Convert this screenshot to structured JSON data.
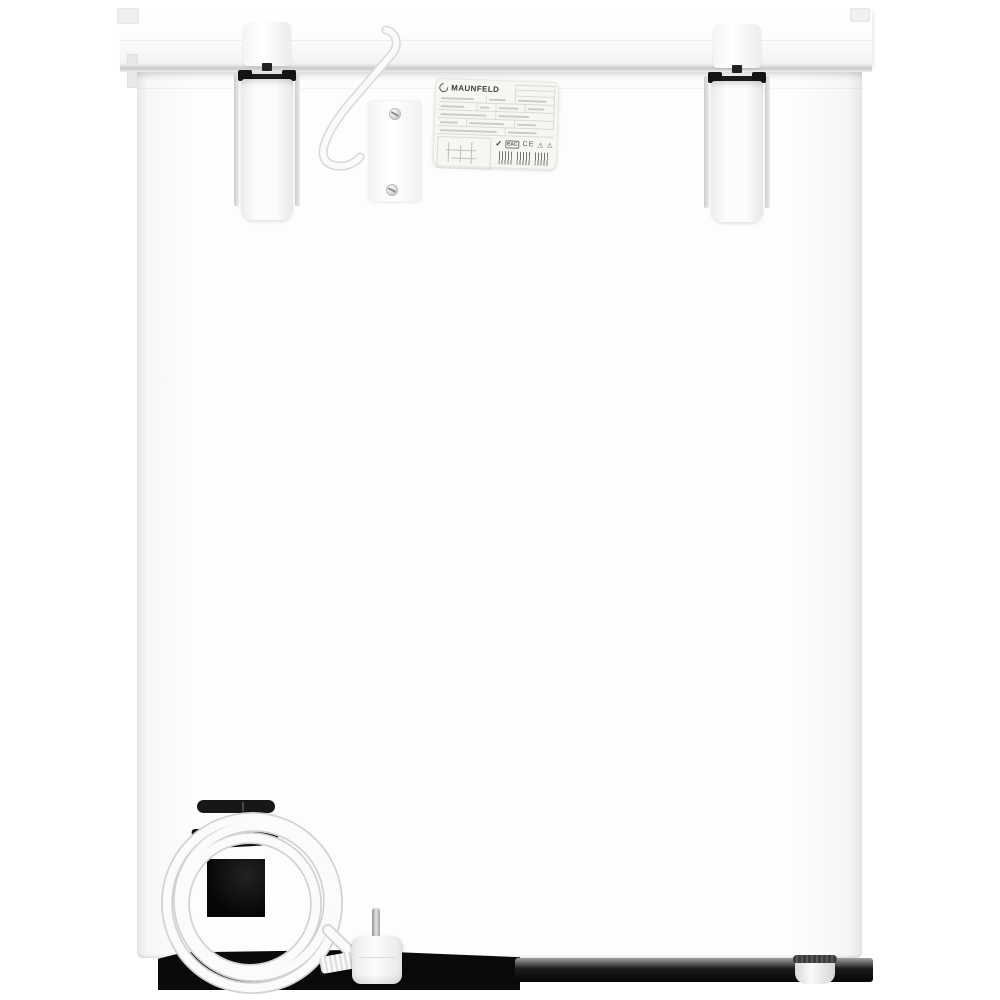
{
  "photo": {
    "subject": "White chest freezer, rear view product photo",
    "background": "#ffffff"
  },
  "rating_label": {
    "brand": "MAUNFELD",
    "logo_icon": "maunfeld-ring-logo",
    "conformity_marks": [
      {
        "name": "checkmark-icon",
        "glyph": "✓"
      },
      {
        "name": "eac-mark-icon",
        "text": "EAC"
      },
      {
        "name": "ce-mark-icon",
        "text": "CE"
      },
      {
        "name": "warning-triangle-icon",
        "glyph": "⚠"
      },
      {
        "name": "warning-triangle-icon",
        "glyph": "⚠"
      }
    ],
    "barcode_count": 3
  },
  "colors": {
    "cabinet_white": "#fbfbfb",
    "seam_gray": "#c9c9c9",
    "hardware_dark": "#161616",
    "shadow_black": "#070707",
    "cable_white": "#fafafa",
    "label_background": "#f7f6f3"
  }
}
